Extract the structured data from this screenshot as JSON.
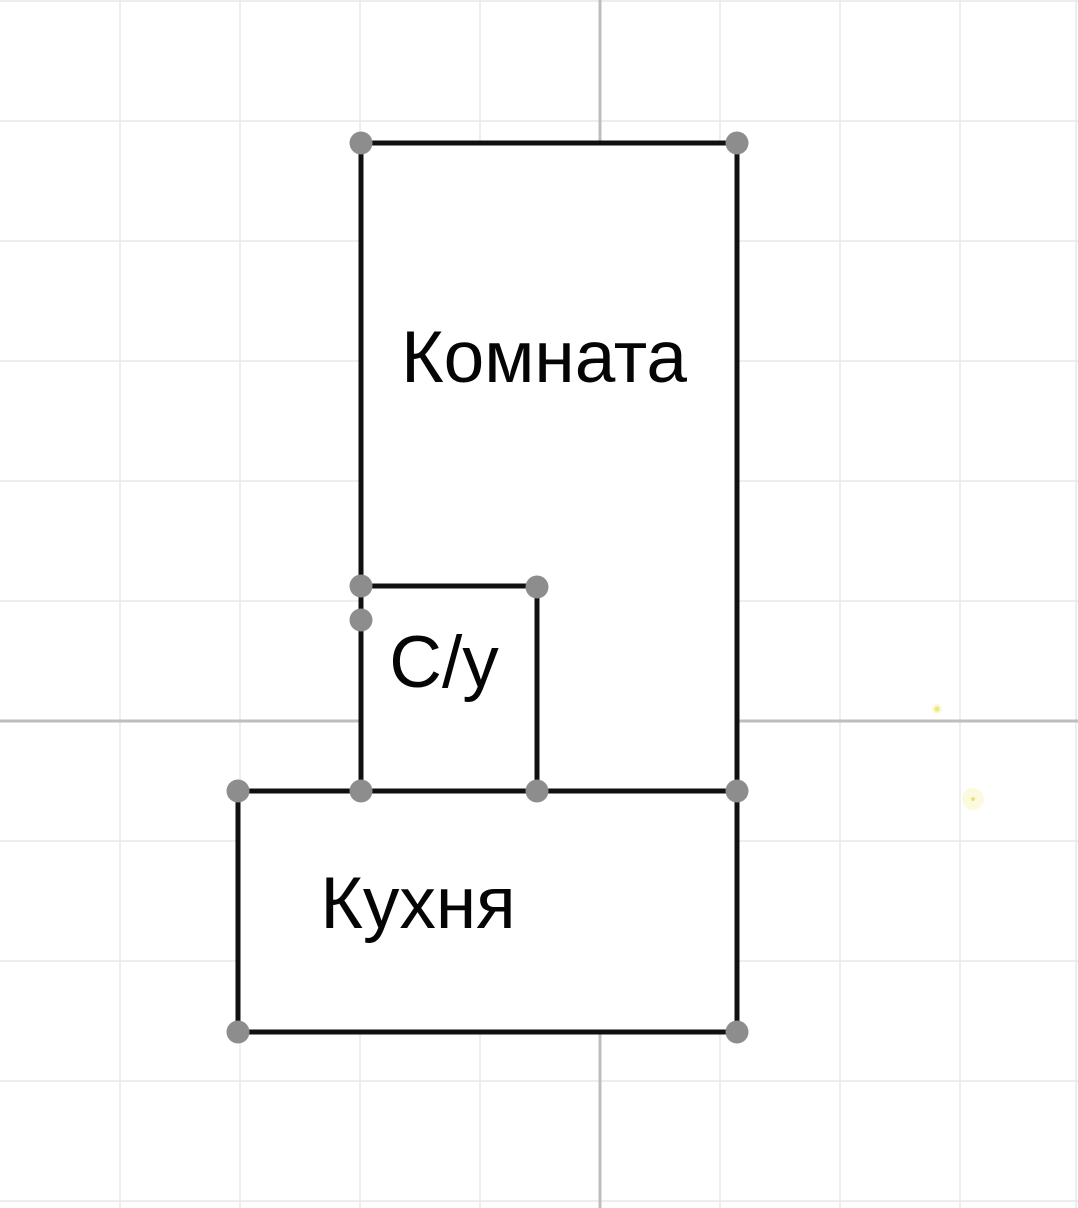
{
  "canvas": {
    "width": 1078,
    "height": 1208,
    "background": "#ffffff"
  },
  "grid": {
    "light_color": "#e7e7e7",
    "dark_color": "#bdbdbd",
    "light_width": 1.4,
    "dark_width": 3,
    "vertical_light": [
      120,
      240,
      360,
      480,
      720,
      840,
      960,
      1076
    ],
    "vertical_dark": [
      600
    ],
    "horizontal_light": [
      1,
      121,
      241,
      361,
      481,
      601,
      841,
      961,
      1081,
      1201
    ],
    "horizontal_dark": [
      721
    ]
  },
  "rooms": [
    {
      "id": "komnata",
      "label": "Комната",
      "x": 361,
      "y": 143,
      "w": 376,
      "h": 648,
      "label_cx": 544,
      "label_baseline": 382
    },
    {
      "id": "su",
      "label": "С/у",
      "x": 361,
      "y": 586,
      "w": 176,
      "h": 205,
      "label_cx": 444,
      "label_baseline": 687
    },
    {
      "id": "kuhnya",
      "label": "Кухня",
      "x": 238,
      "y": 791,
      "w": 499,
      "h": 241,
      "label_cx": 418,
      "label_baseline": 928
    }
  ],
  "text_style": {
    "size": 73,
    "color": "#050505"
  },
  "walls": {
    "color": "#101010",
    "width": 5,
    "segments": [
      [
        361,
        143,
        737,
        143
      ],
      [
        737,
        143,
        737,
        1032
      ],
      [
        361,
        143,
        361,
        791
      ],
      [
        361,
        586,
        537,
        586
      ],
      [
        537,
        586,
        537,
        791
      ],
      [
        238,
        791,
        737,
        791
      ],
      [
        238,
        791,
        238,
        1032
      ],
      [
        238,
        1032,
        737,
        1032
      ]
    ]
  },
  "handles": {
    "color": "#8d8d8d",
    "radius": 11.5,
    "points": [
      [
        361,
        143
      ],
      [
        737,
        143
      ],
      [
        361,
        586
      ],
      [
        361,
        620
      ],
      [
        537,
        587
      ],
      [
        238,
        791
      ],
      [
        361,
        791
      ],
      [
        537,
        791
      ],
      [
        737,
        791
      ],
      [
        238,
        1032
      ],
      [
        737,
        1032
      ]
    ]
  },
  "accent_dots": [
    {
      "x": 937,
      "y": 709,
      "r": 2.5,
      "halo_r": 5,
      "color": "#ece67e",
      "halo_color": "#f3efa3",
      "halo_opacity": 0.45
    },
    {
      "x": 973,
      "y": 799,
      "r": 2.0,
      "halo_r": 11,
      "color": "#e9e27a",
      "halo_color": "#f6f3b0",
      "halo_opacity": 0.4
    }
  ]
}
